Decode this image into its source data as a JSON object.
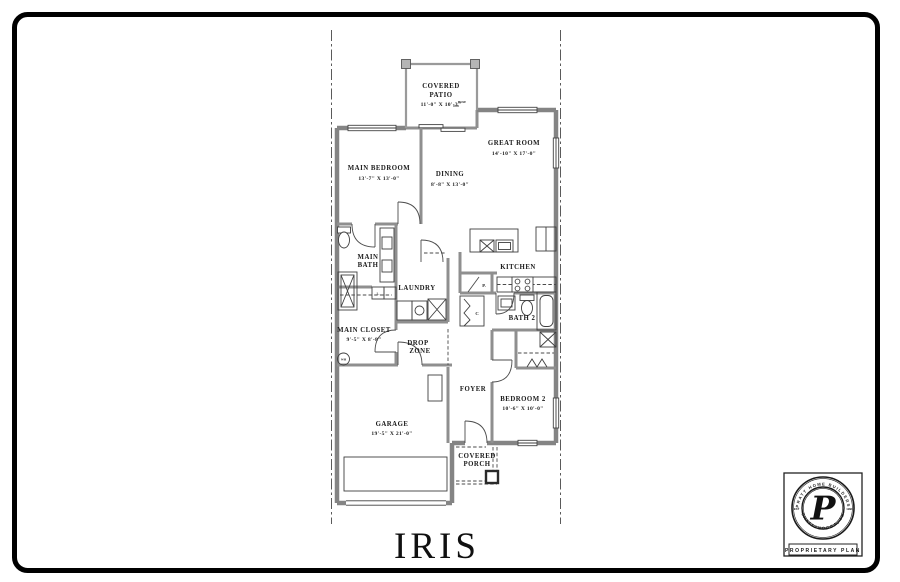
{
  "title": "IRIS",
  "plan": {
    "rooms": {
      "covered_patio": {
        "line1": "COVERED",
        "line2": "PATIO",
        "dims": "11'-0\" X 10'-3\""
      },
      "great_room": {
        "line1": "GREAT ROOM",
        "dims": "14'-10\" X 17'-0\""
      },
      "main_bedroom": {
        "line1": "MAIN BEDROOM",
        "dims": "13'-7\" X 13'-0\""
      },
      "dining": {
        "line1": "DINING",
        "dims": "8'-8\" X 13'-0\""
      },
      "main_bath": {
        "line1": "MAIN",
        "line2": "BATH"
      },
      "laundry": {
        "line1": "LAUNDRY"
      },
      "kitchen": {
        "line1": "KITCHEN"
      },
      "bath_2": {
        "line1": "BATH 2"
      },
      "main_closet": {
        "line1": "MAIN CLOSET",
        "dims": "9'-5\" X 8'-8\""
      },
      "drop_zone": {
        "line1": "DROP",
        "line2": "ZONE"
      },
      "foyer": {
        "line1": "FOYER"
      },
      "bedroom_2": {
        "line1": "BEDROOM 2",
        "dims": "10'-6\" X 10'-0\""
      },
      "garage": {
        "line1": "GARAGE",
        "dims": "19'-5\" X 21'-0\""
      },
      "covered_porch": {
        "line1": "COVERED",
        "line2": "PORCH"
      }
    },
    "tags": {
      "hose": "HOSE",
      "pantry": "P.",
      "coat_closet": "C",
      "water_heater": "WH",
      "linen": "L."
    }
  },
  "stamp": {
    "ring_top": "PRATT HOME BUILDERS",
    "ring_bottom": "CHATTANOOGA, TN",
    "est": "EST",
    "year": "1998",
    "monogram": "P",
    "plate": "PROPRIETARY PLAN"
  },
  "colors": {
    "border": "#000000",
    "wall": "#8f8f8f",
    "line": "#3f3f3f",
    "ink": "#1c1c1c"
  }
}
